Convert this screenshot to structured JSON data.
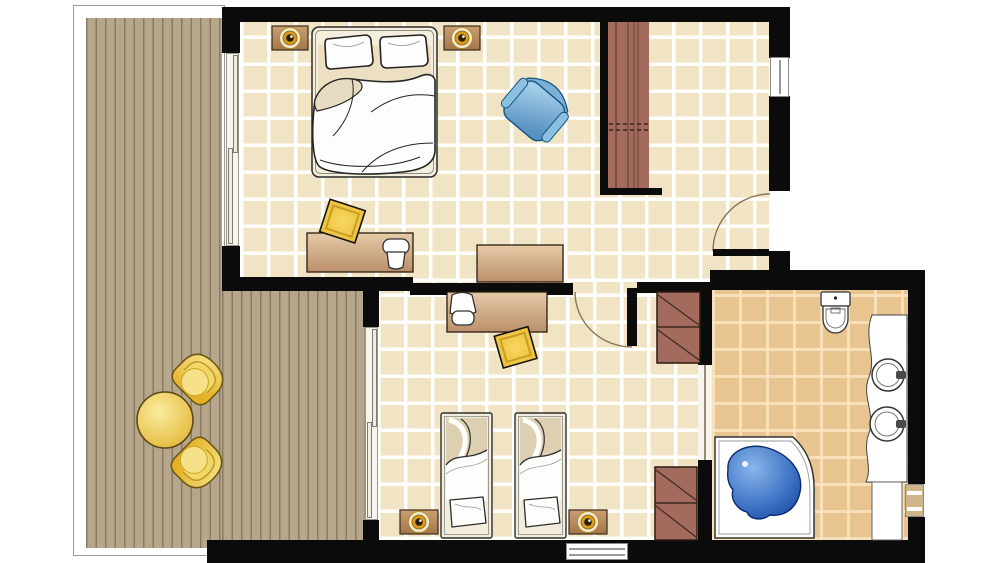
{
  "meta": {
    "type": "floor-plan",
    "view": "top-down",
    "subject": "hotel suite with terrace, two bedrooms and bathroom"
  },
  "rooms": [
    {
      "name": "terrace-deck",
      "floor": "wood-planks",
      "furniture": [
        "round-patio-table",
        "patio-tub-chair",
        "patio-tub-chair"
      ]
    },
    {
      "name": "master-bedroom",
      "floor": "light-tile",
      "furniture": [
        "double-bed",
        "nightstand-with-lamp",
        "nightstand-with-lamp",
        "desk",
        "stool",
        "rug",
        "blue-armchair"
      ]
    },
    {
      "name": "entry-hall",
      "floor": "light-tile",
      "furniture": [
        "wardrobe-closet",
        "console-vanity-table"
      ]
    },
    {
      "name": "second-bedroom",
      "floor": "light-tile",
      "furniture": [
        "twin-bed",
        "twin-bed",
        "nightstand-with-lamp",
        "nightstand-with-lamp",
        "desk",
        "chair",
        "rug",
        "shelf-unit",
        "shelf-unit"
      ]
    },
    {
      "name": "bathroom",
      "floor": "dark-tile",
      "fixtures": [
        "wall-hung-toilet",
        "double-sink-vanity-counter",
        "corner-bathtub"
      ]
    }
  ],
  "doors": [
    {
      "name": "entry-door",
      "type": "swing-with-arc"
    },
    {
      "name": "second-bedroom-door",
      "type": "swing-with-arc"
    },
    {
      "name": "bathroom-door",
      "type": "sliding"
    },
    {
      "name": "master-terrace-door",
      "type": "sliding-glass"
    },
    {
      "name": "second-bedroom-terrace-door",
      "type": "sliding-glass"
    }
  ],
  "windows": [
    "entry-hall-window",
    "bathroom-window",
    "second-bedroom-window"
  ],
  "colors": {
    "wall": "#0b0b0b",
    "tile_light": "#f1e4c4",
    "tile_dark": "#e8c491",
    "deck_base": "#b5a68c",
    "deck_line": "#8b7b63",
    "outline_gray": "#9a9a9a",
    "wood_light": "#e6cba8",
    "wood_dark": "#bb8f6b",
    "closet_wood": "#a26b5d",
    "closet_line": "#6a4438",
    "rug_gold": "#f2c23c",
    "lamp_gold": "#d99b1d",
    "armchair_blue": "#5590c0",
    "tub_blue": "#16439b",
    "patio_yellow": "#e9bc33",
    "linen_white": "#fdfdfb",
    "door_arc": "#8a7454"
  }
}
